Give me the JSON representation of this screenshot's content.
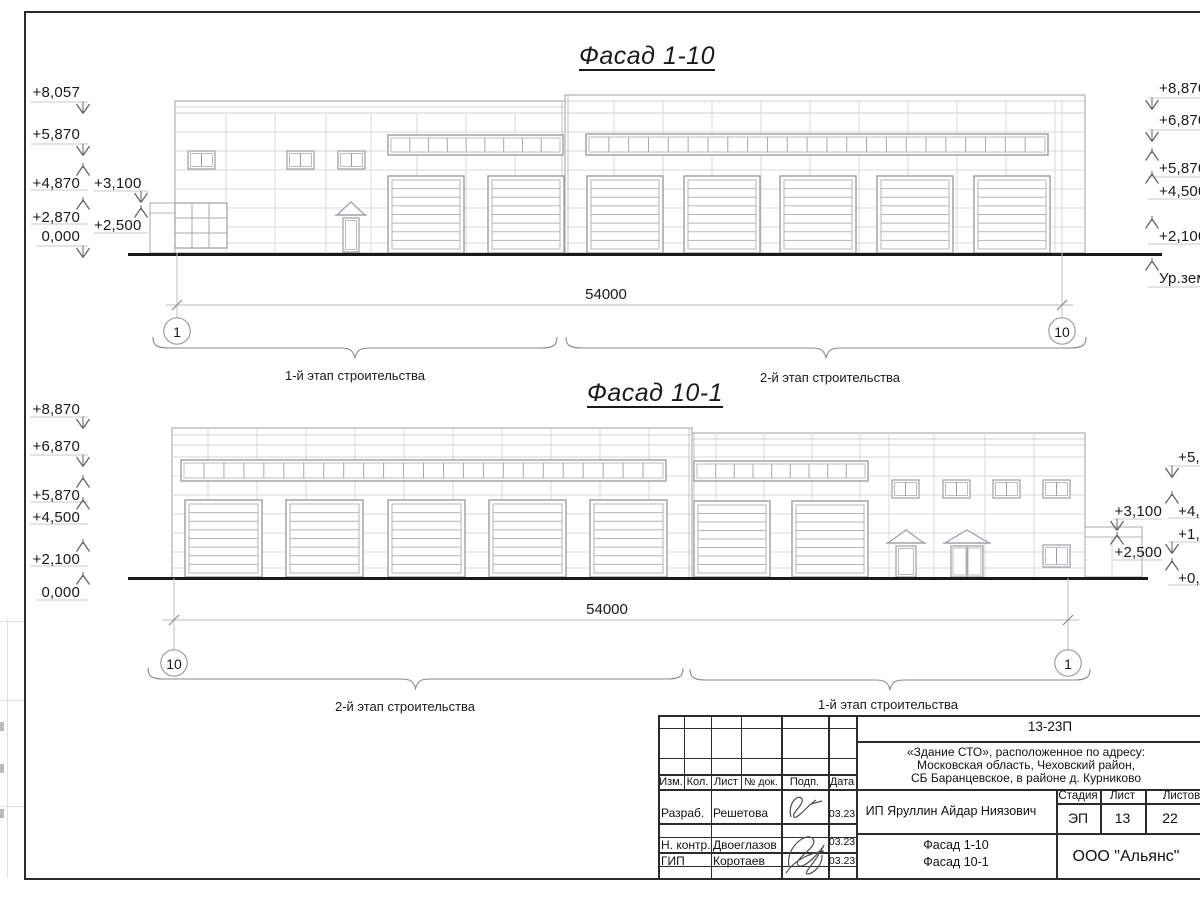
{
  "colors": {
    "ink": "#1a1a1a",
    "line_light": "#c9c9c9",
    "line_mid": "#9aa0a3",
    "ground": "#161616"
  },
  "facade1": {
    "title": "Фасад 1-10",
    "dim": "54000",
    "axis_left": "1",
    "axis_right": "10",
    "stage_left": "1-й этап строительства",
    "stage_right": "2-й этап строительства",
    "levels_left": [
      "+8,057",
      "+5,870",
      "+4,870",
      "+3,100",
      "+2,870",
      "+2,500",
      "0,000"
    ],
    "levels_right": [
      "+8,870",
      "+6,870",
      "+5,870",
      "+4,500",
      "+2,100",
      "Ур.земли"
    ]
  },
  "facade2": {
    "title": "Фасад 10-1",
    "dim": "54000",
    "axis_left": "10",
    "axis_right": "1",
    "stage_left": "2-й этап строительства",
    "stage_right": "1-й этап строительства",
    "levels_left": [
      "+8,870",
      "+6,870",
      "+5,870",
      "+4,500",
      "+2,100",
      "0,000"
    ],
    "levels_annex": [
      "+3,100",
      "+2,500"
    ],
    "levels_right": [
      "+5,870",
      "+4,870",
      "+1,870",
      "+0,870"
    ]
  },
  "sheet": {
    "code": "13-23П",
    "object_lines": [
      "«Здание СТО», расположенное по адресу:",
      "Московская область, Чеховский район,",
      "СБ Баранцевское, в районе д. Курниково"
    ],
    "client": "ИП Яруллин Айдар Ниязович",
    "company": "ООО \"Альянс\"",
    "stamp": {
      "cols": {
        "izm": "Изм.",
        "kol": "Кол.",
        "list": "Лист",
        "doc": "№ док.",
        "podp": "Подп.",
        "data": "Дата"
      },
      "stage_label": "Стадия",
      "sheet_label": "Лист",
      "sheets_label": "Листов",
      "stage": "ЭП",
      "sheet_no": "13",
      "sheets_total": "22",
      "rows": [
        {
          "role": "Разраб.",
          "name": "Решетова",
          "date": "03.23"
        },
        {
          "role": "Н. контр.",
          "name": "Двоеглазов",
          "date": "03.23"
        },
        {
          "role": "ГИП",
          "name": "Коротаев",
          "date": "03.23"
        }
      ]
    }
  }
}
